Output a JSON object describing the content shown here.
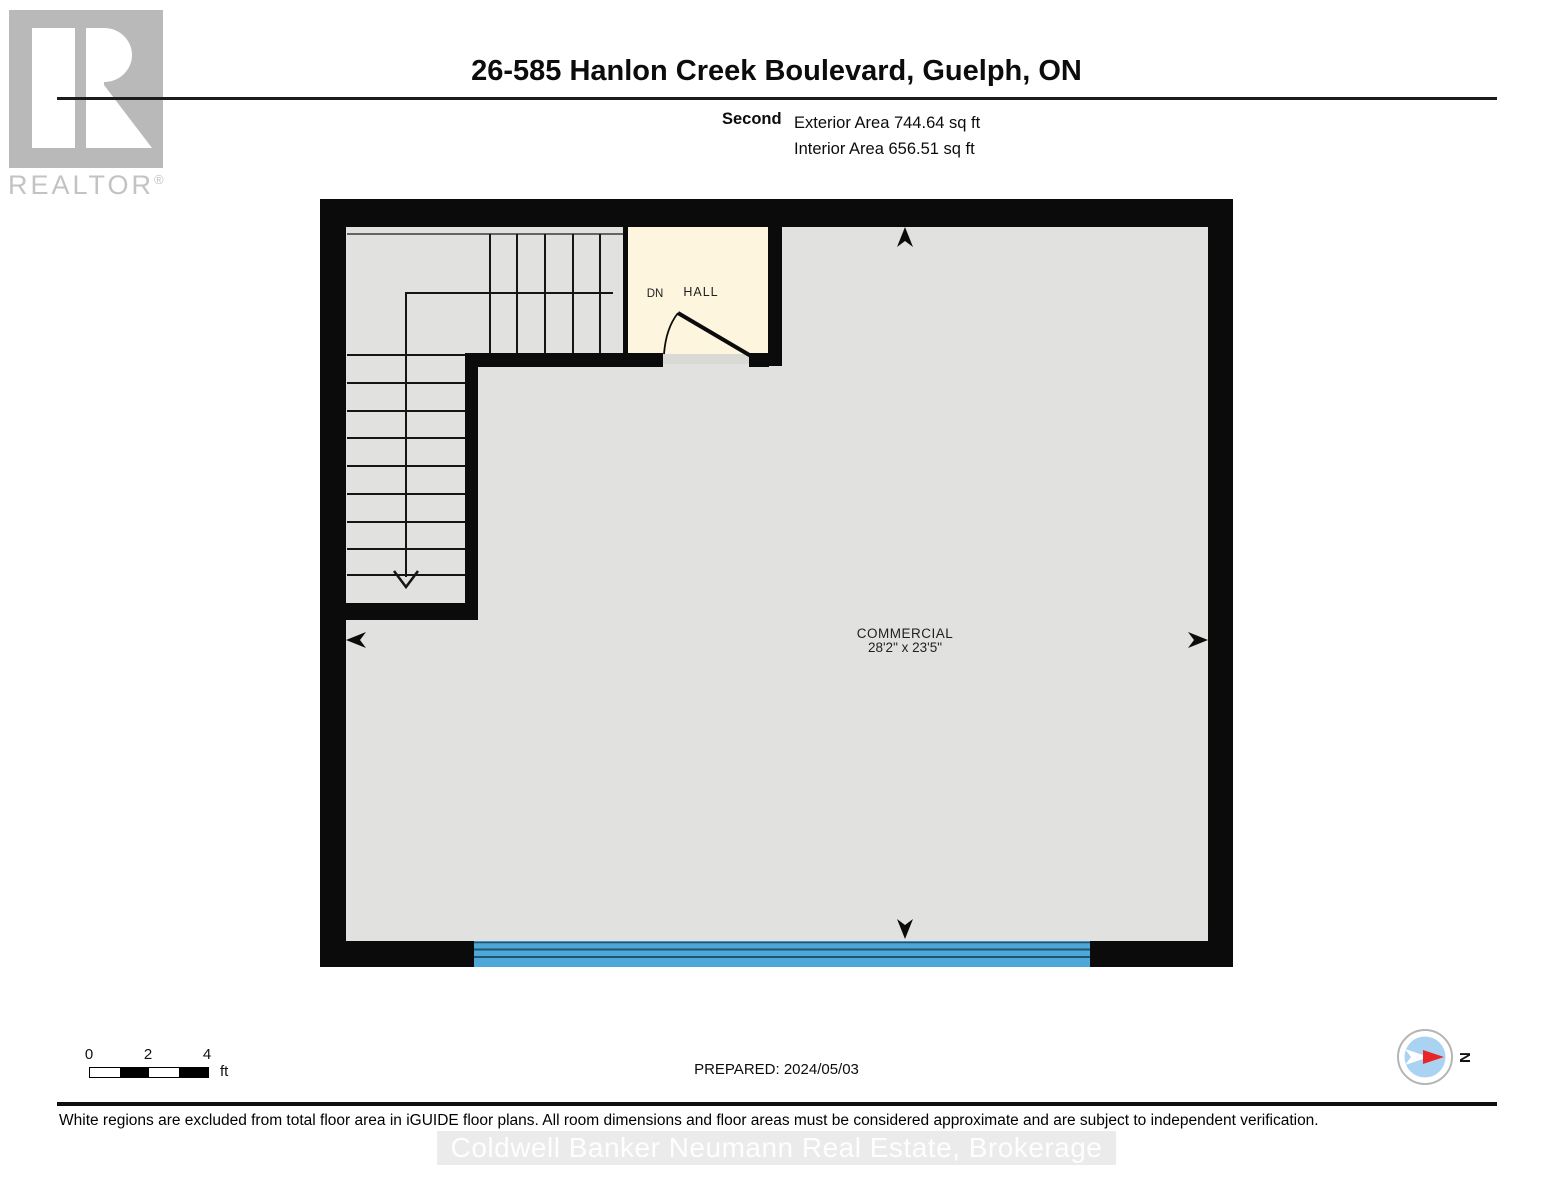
{
  "logo": {
    "box_letter": "R",
    "brand": "REALTOR",
    "registered": "®"
  },
  "header": {
    "title": "26-585 Hanlon Creek Boulevard, Guelph, ON",
    "floor_label": "Second",
    "exterior_area": "Exterior Area 744.64 sq ft",
    "interior_area": "Interior Area 656.51 sq ft"
  },
  "plan": {
    "rooms": [
      {
        "name": "COMMERCIAL",
        "dimensions": "28'2\" x 23'5\""
      },
      {
        "name": "HALL",
        "dimensions": ""
      }
    ],
    "stair_label": "DN",
    "colors": {
      "wall": "#0b0b0b",
      "floor": "#e1e1e0",
      "hall_excluded": "#fdf5de",
      "window_blue": "#4da7d9"
    }
  },
  "footer": {
    "scale": {
      "tick0": "0",
      "tick2": "2",
      "tick4": "4",
      "unit": "ft"
    },
    "prepared": "PREPARED: 2024/05/03",
    "compass_label": "N",
    "disclaimer": "White regions are excluded from total floor area in iGUIDE floor plans. All room dimensions and floor areas must be considered approximate and are subject to independent verification.",
    "watermark": "Coldwell Banker Neumann Real Estate, Brokerage"
  }
}
